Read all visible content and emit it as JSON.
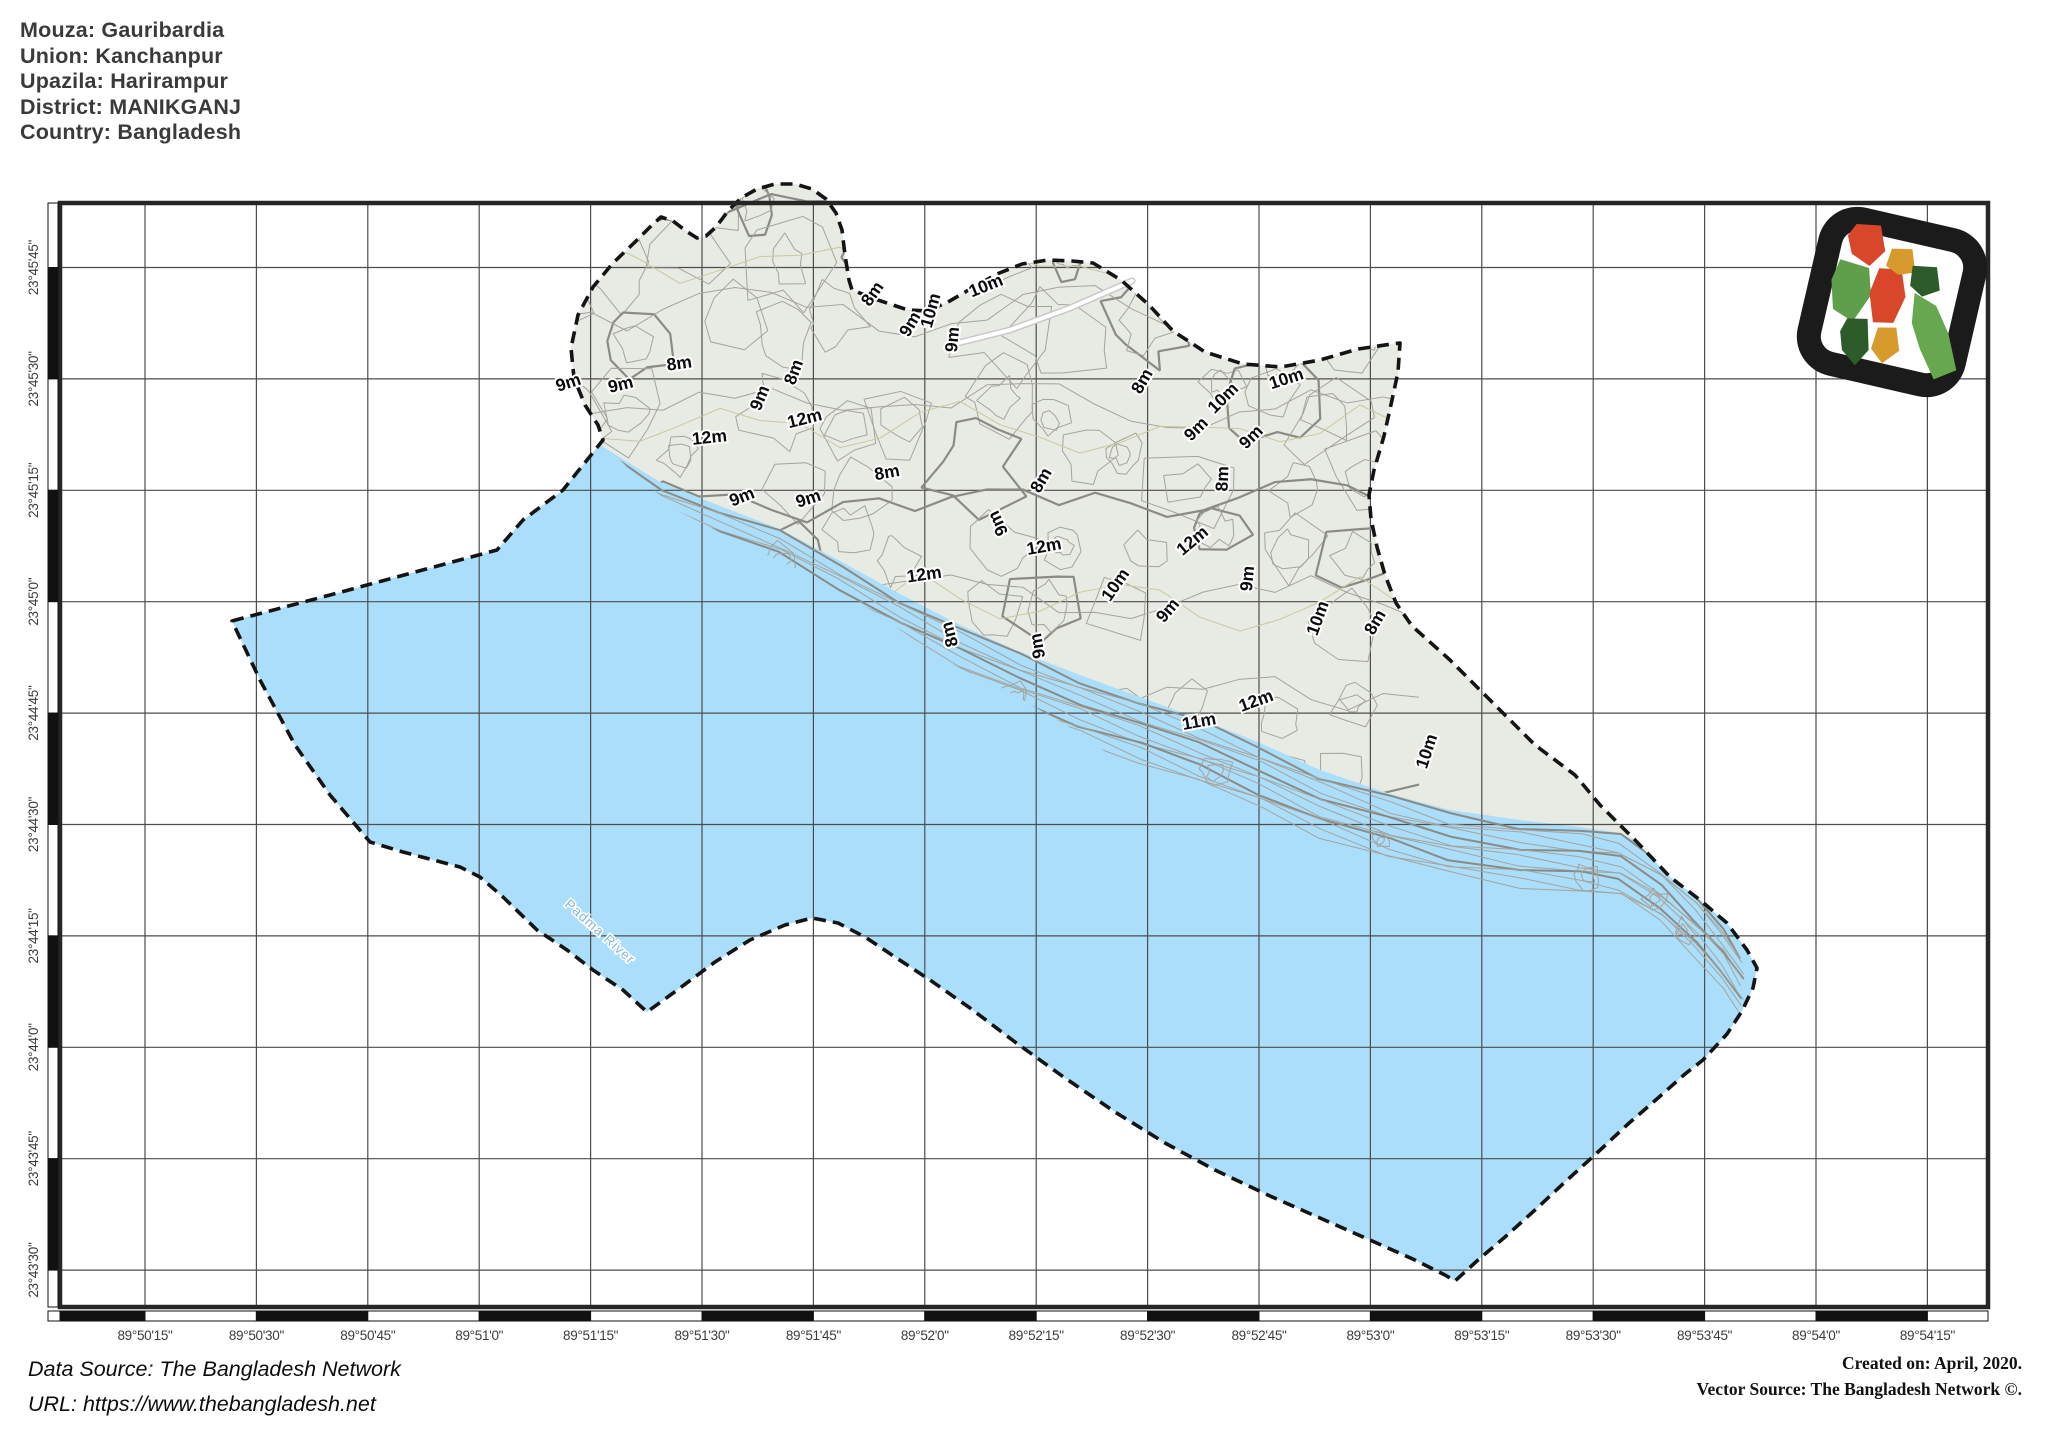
{
  "title_block": {
    "lines": [
      "Mouza: Gauribardia",
      "Union: Kanchanpur",
      "Upazila: Harirampur",
      "District: MANIKGANJ",
      "Country: Bangladesh"
    ]
  },
  "map": {
    "x_axis_labels": [
      "89°50'15\"",
      "89°50'30\"",
      "89°50'45\"",
      "89°51'0\"",
      "89°51'15\"",
      "89°51'30\"",
      "89°51'45\"",
      "89°52'0\"",
      "89°52'15\"",
      "89°52'30\"",
      "89°52'45\"",
      "89°53'0\"",
      "89°53'15\"",
      "89°53'30\"",
      "89°53'45\"",
      "89°54'0\"",
      "89°54'15\""
    ],
    "y_axis_labels": [
      "23°45'45\"",
      "23°45'30\"",
      "23°45'15\"",
      "23°45'0\"",
      "23°44'45\"",
      "23°44'30\"",
      "23°44'15\"",
      "23°44'0\"",
      "23°43'45\"",
      "23°43'30\""
    ],
    "river_label": "Padma River",
    "contour_labels": [
      {
        "text": "9m",
        "x": 570,
        "y": 388,
        "rot": -18
      },
      {
        "text": "9m",
        "x": 622,
        "y": 390,
        "rot": -14
      },
      {
        "text": "8m",
        "x": 680,
        "y": 369,
        "rot": -8
      },
      {
        "text": "9m",
        "x": 765,
        "y": 400,
        "rot": -68
      },
      {
        "text": "8m",
        "x": 799,
        "y": 374,
        "rot": -70
      },
      {
        "text": "12m",
        "x": 806,
        "y": 424,
        "rot": -14
      },
      {
        "text": "12m",
        "x": 710,
        "y": 443,
        "rot": -6
      },
      {
        "text": "8m",
        "x": 877,
        "y": 297,
        "rot": -55
      },
      {
        "text": "9m",
        "x": 915,
        "y": 327,
        "rot": -60
      },
      {
        "text": "10m",
        "x": 936,
        "y": 312,
        "rot": -75
      },
      {
        "text": "9m",
        "x": 958,
        "y": 340,
        "rot": -85
      },
      {
        "text": "10m",
        "x": 988,
        "y": 291,
        "rot": -22
      },
      {
        "text": "8m",
        "x": 888,
        "y": 478,
        "rot": -10
      },
      {
        "text": "9m",
        "x": 744,
        "y": 502,
        "rot": -22
      },
      {
        "text": "9m",
        "x": 810,
        "y": 504,
        "rot": -18
      },
      {
        "text": "9m",
        "x": 1003,
        "y": 521,
        "rot": -115
      },
      {
        "text": "8m",
        "x": 1046,
        "y": 483,
        "rot": -60
      },
      {
        "text": "12m",
        "x": 1045,
        "y": 552,
        "rot": -10
      },
      {
        "text": "12m",
        "x": 925,
        "y": 580,
        "rot": -8
      },
      {
        "text": "8m",
        "x": 955,
        "y": 633,
        "rot": -105
      },
      {
        "text": "9m",
        "x": 1043,
        "y": 645,
        "rot": -100
      },
      {
        "text": "8m",
        "x": 1147,
        "y": 384,
        "rot": -60
      },
      {
        "text": "10m",
        "x": 1227,
        "y": 402,
        "rot": -45
      },
      {
        "text": "10m",
        "x": 1288,
        "y": 384,
        "rot": -18
      },
      {
        "text": "9m",
        "x": 1200,
        "y": 433,
        "rot": -45
      },
      {
        "text": "9m",
        "x": 1255,
        "y": 441,
        "rot": -45
      },
      {
        "text": "8m",
        "x": 1228,
        "y": 479,
        "rot": -88
      },
      {
        "text": "12m",
        "x": 1196,
        "y": 545,
        "rot": -40
      },
      {
        "text": "9m",
        "x": 1253,
        "y": 579,
        "rot": -85
      },
      {
        "text": "9m",
        "x": 1172,
        "y": 614,
        "rot": -50
      },
      {
        "text": "10m",
        "x": 1323,
        "y": 620,
        "rot": -70
      },
      {
        "text": "8m",
        "x": 1380,
        "y": 625,
        "rot": -60
      },
      {
        "text": "11m",
        "x": 1200,
        "y": 727,
        "rot": -10
      },
      {
        "text": "12m",
        "x": 1258,
        "y": 706,
        "rot": -20
      },
      {
        "text": "10m",
        "x": 1432,
        "y": 753,
        "rot": -72
      },
      {
        "text": "10m",
        "x": 1120,
        "y": 588,
        "rot": -55
      }
    ]
  },
  "footer": {
    "data_source": "Data Source: The Bangladesh Network",
    "url": "URL: https://www.thebangladesh.net",
    "created": "Created on: April, 2020.",
    "vector_source": "Vector Source: The Bangladesh Network ©."
  },
  "colors": {
    "water": "#abdefa",
    "land": "#e8eae4",
    "contour": "#a4a49e",
    "contour_index": "#8b8b86",
    "contour_faint": "#c6caa0",
    "boundary": "#141414",
    "grid": "#4d4d4d",
    "frame": "#262626",
    "river_text": "#85b7d6",
    "logo_red": "#d9472b",
    "logo_green": "#5f9e4a",
    "logo_dark_green": "#2e5b2a",
    "logo_gold": "#d69a2d",
    "logo_light_green": "#66a74f"
  }
}
